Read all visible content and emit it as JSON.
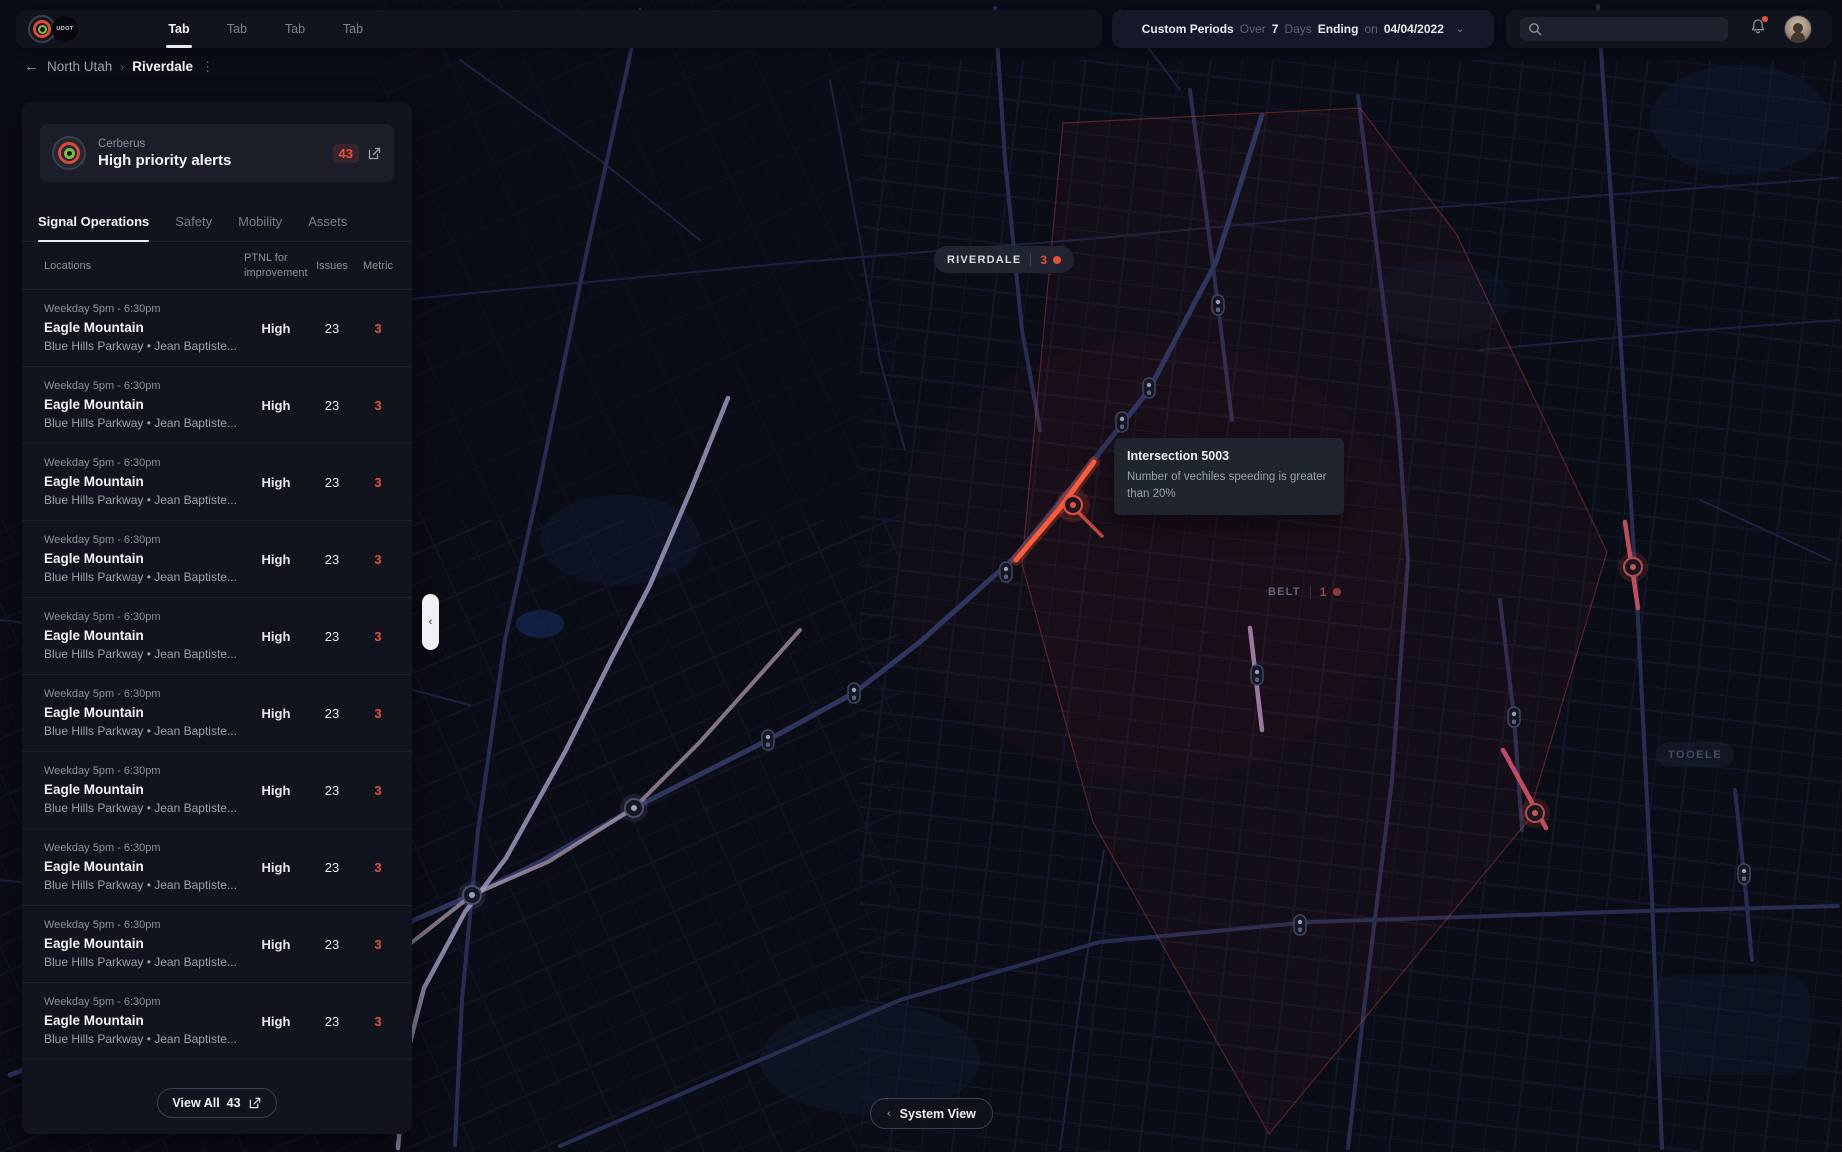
{
  "topbar": {
    "logo_text": "UDOT",
    "tabs": [
      {
        "label": "Tab",
        "active": true
      },
      {
        "label": "Tab",
        "active": false
      },
      {
        "label": "Tab",
        "active": false
      },
      {
        "label": "Tab",
        "active": false
      }
    ],
    "period": {
      "title": "Custom Periods",
      "over_label": "Over",
      "days_value": "7",
      "days_label": "Days",
      "ending_label": "Ending",
      "on_label": "on",
      "date": "04/04/2022"
    },
    "search": {
      "value": "",
      "placeholder": ""
    }
  },
  "breadcrumb": {
    "back": "←",
    "parent": "North Utah",
    "separator": "›",
    "current": "Riverdale",
    "kebab": "⋮"
  },
  "panel": {
    "card": {
      "source": "Cerberus",
      "title": "High priority alerts",
      "count": "43"
    },
    "tabs": [
      {
        "label": "Signal Operations",
        "active": true
      },
      {
        "label": "Safety",
        "active": false
      },
      {
        "label": "Mobility",
        "active": false
      },
      {
        "label": "Assets",
        "active": false
      }
    ],
    "columns": {
      "locations": "Locations",
      "ptnl": "PTNL for improvement",
      "issues": "Issues",
      "metric": "Metric"
    },
    "rows": [
      {
        "time": "Weekday 5pm - 6:30pm",
        "name": "Eagle Mountain",
        "detail": "Blue Hills Parkway  •  Jean Baptiste...",
        "ptnl": "High",
        "issues": "23",
        "metric": "3"
      },
      {
        "time": "Weekday 5pm - 6:30pm",
        "name": "Eagle Mountain",
        "detail": "Blue Hills Parkway  •  Jean Baptiste...",
        "ptnl": "High",
        "issues": "23",
        "metric": "3"
      },
      {
        "time": "Weekday 5pm - 6:30pm",
        "name": "Eagle Mountain",
        "detail": "Blue Hills Parkway  •  Jean Baptiste...",
        "ptnl": "High",
        "issues": "23",
        "metric": "3"
      },
      {
        "time": "Weekday 5pm - 6:30pm",
        "name": "Eagle Mountain",
        "detail": "Blue Hills Parkway  •  Jean Baptiste...",
        "ptnl": "High",
        "issues": "23",
        "metric": "3"
      },
      {
        "time": "Weekday 5pm - 6:30pm",
        "name": "Eagle Mountain",
        "detail": "Blue Hills Parkway  •  Jean Baptiste...",
        "ptnl": "High",
        "issues": "23",
        "metric": "3"
      },
      {
        "time": "Weekday 5pm - 6:30pm",
        "name": "Eagle Mountain",
        "detail": "Blue Hills Parkway  •  Jean Baptiste...",
        "ptnl": "High",
        "issues": "23",
        "metric": "3"
      },
      {
        "time": "Weekday 5pm - 6:30pm",
        "name": "Eagle Mountain",
        "detail": "Blue Hills Parkway  •  Jean Baptiste...",
        "ptnl": "High",
        "issues": "23",
        "metric": "3"
      },
      {
        "time": "Weekday 5pm - 6:30pm",
        "name": "Eagle Mountain",
        "detail": "Blue Hills Parkway  •  Jean Baptiste...",
        "ptnl": "High",
        "issues": "23",
        "metric": "3"
      },
      {
        "time": "Weekday 5pm - 6:30pm",
        "name": "Eagle Mountain",
        "detail": "Blue Hills Parkway  •  Jean Baptiste...",
        "ptnl": "High",
        "issues": "23",
        "metric": "3"
      },
      {
        "time": "Weekday 5pm - 6:30pm",
        "name": "Eagle Mountain",
        "detail": "Blue Hills Parkway  •  Jean Baptiste...",
        "ptnl": "High",
        "issues": "23",
        "metric": "3"
      }
    ],
    "view_all": {
      "label": "View All",
      "count": "43"
    }
  },
  "map": {
    "districts": {
      "riverdale": {
        "name": "RIVERDALE",
        "count": "3"
      },
      "belt": {
        "name": "BELT",
        "count": "1"
      },
      "tooele": {
        "name": "TOOELE"
      }
    },
    "tooltip": {
      "title": "Intersection 5003",
      "description": "Number of vechiles speeding is greater than 20%"
    },
    "system_view": {
      "chevron": "‹",
      "label": "System View"
    }
  },
  "colors": {
    "accent_red": "#e8503a",
    "alert_highlight": "#ff5b38",
    "panel_bg": "#12141d",
    "map_bg": "#0a0c16",
    "text_primary": "#f2f3f6",
    "text_muted": "#8a8f9c"
  }
}
